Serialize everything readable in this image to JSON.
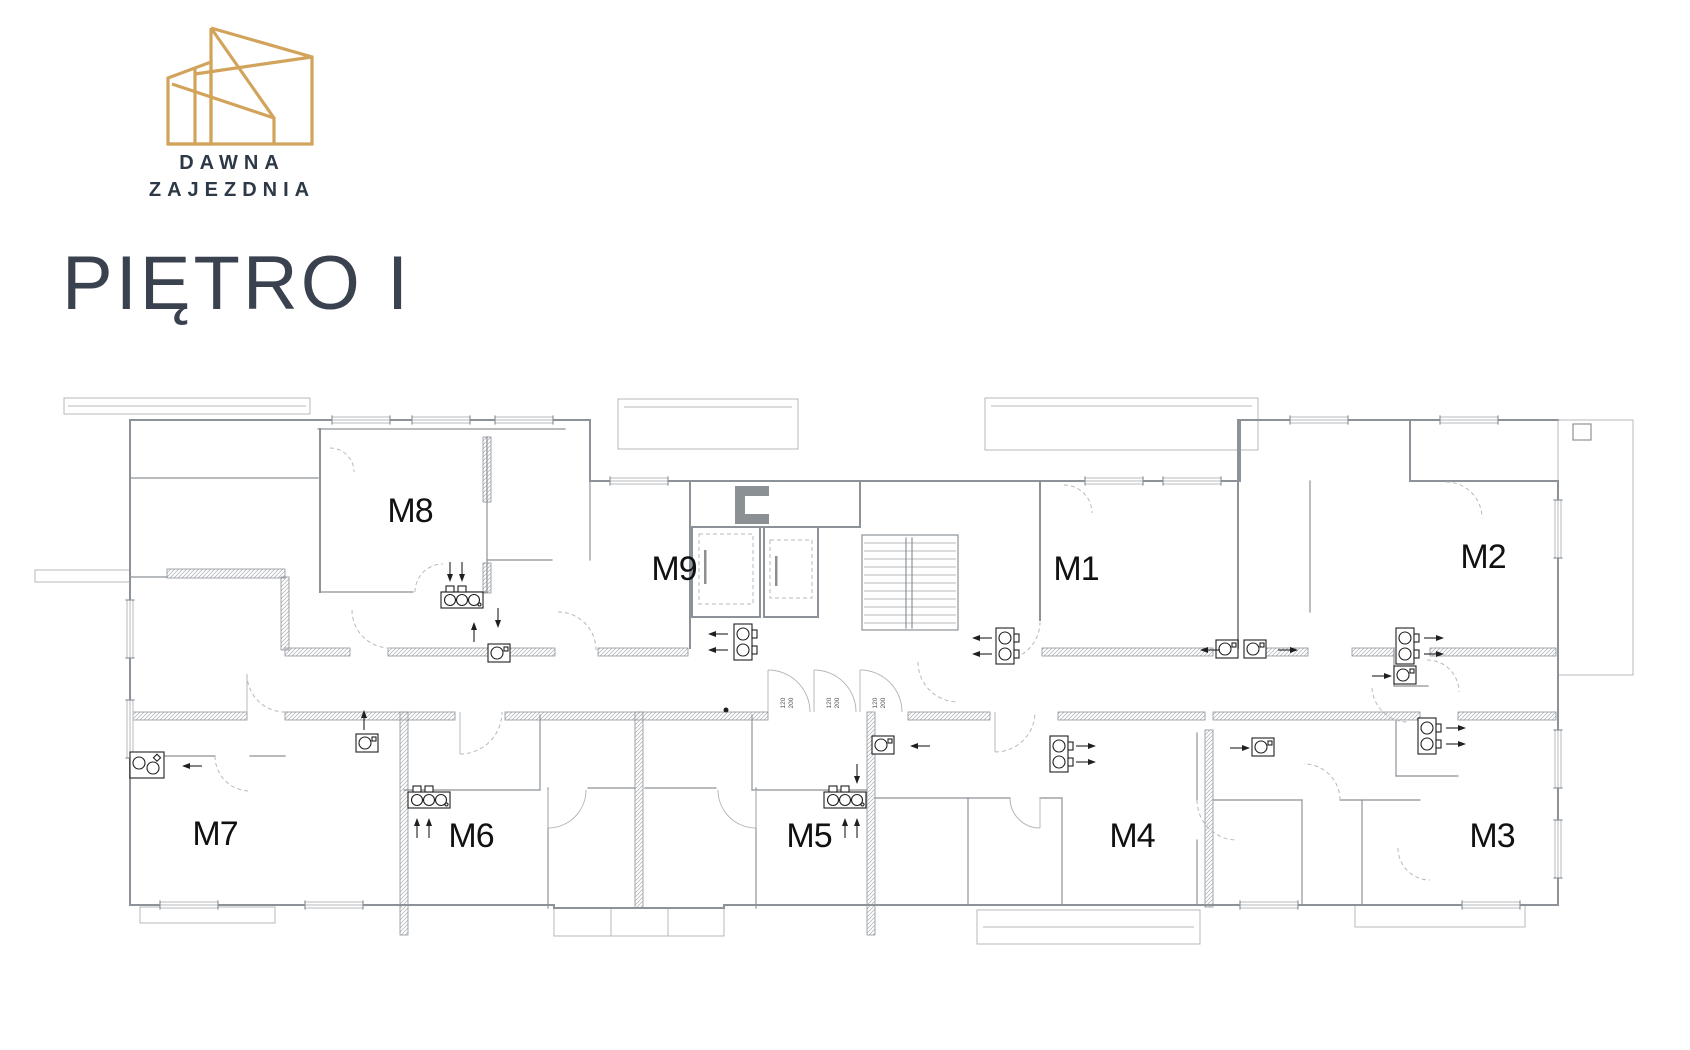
{
  "brand": {
    "name_line1": "DAWNA",
    "name_line2": "ZAJEZDNIA"
  },
  "page": {
    "title": "PIĘTRO I"
  },
  "plan": {
    "units": [
      {
        "label": "M1"
      },
      {
        "label": "M2"
      },
      {
        "label": "M3"
      },
      {
        "label": "M4"
      },
      {
        "label": "M5"
      },
      {
        "label": "M6"
      },
      {
        "label": "M7"
      },
      {
        "label": "M8"
      },
      {
        "label": "M9"
      }
    ],
    "door_size": {
      "width": "120",
      "height": "200"
    },
    "colors": {
      "logo_gold": "#D2A45B",
      "brand_navy": "#2E3947",
      "title_slate": "#39424E",
      "wall_gray": "#8D9298",
      "line_light": "#B4B8BC",
      "fixture_black": "#1F1F1F"
    }
  }
}
